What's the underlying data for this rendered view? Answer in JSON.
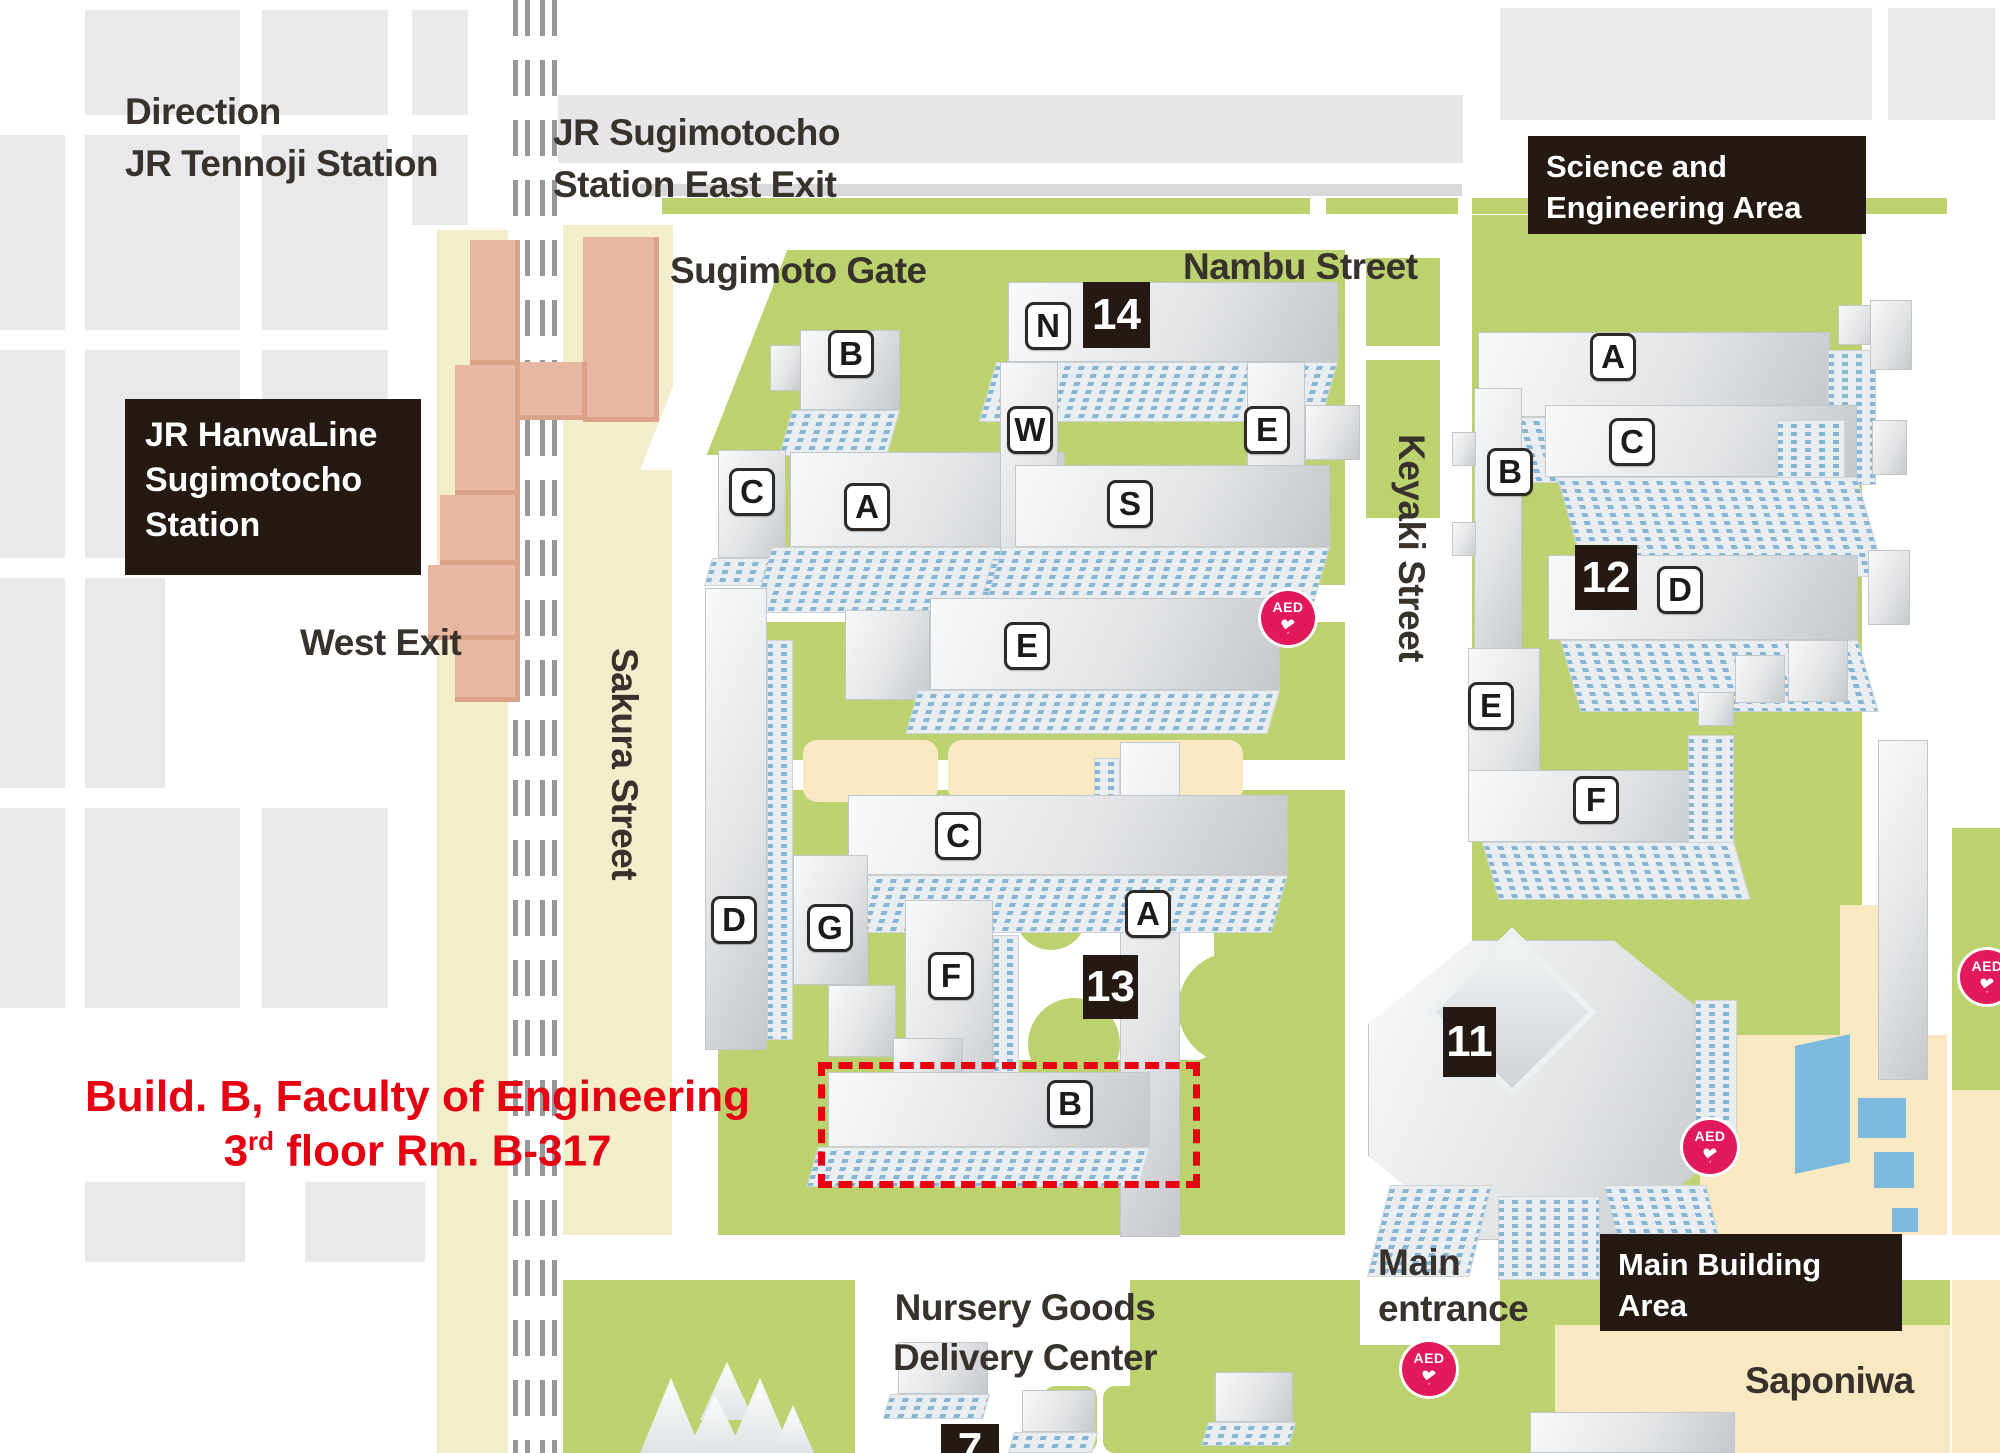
{
  "annotation": {
    "line1": "Build. B, Faculty of Engineering",
    "line2_pre": "3",
    "line2_sup": "rd",
    "line2_post": " floor Rm. B-317"
  },
  "area_badges": {
    "hanwa": [
      "JR HanwaLine",
      "Sugimotocho",
      "Station"
    ],
    "science": [
      "Science and",
      "Engineering Area"
    ],
    "main_building": [
      "Main Building",
      "Area"
    ]
  },
  "number_badges": {
    "n14": "14",
    "n12": "12",
    "n13": "13",
    "n11": "11",
    "n7": "7"
  },
  "streets": {
    "sugimoto_gate": "Sugimoto Gate",
    "nambu": "Nambu Street",
    "sakura": "Sakura Street",
    "keyaki": "Keyaki Street"
  },
  "directions": {
    "tennoji": [
      "Direction",
      "JR Tennoji Station"
    ],
    "east_exit": [
      "JR Sugimotocho",
      "Station East Exit"
    ],
    "west_exit": "West Exit"
  },
  "places": {
    "main_entrance": [
      "Main",
      "entrance"
    ],
    "nursery": [
      "Nursery Goods",
      "Delivery Center"
    ],
    "saponiwa": "Saponiwa"
  },
  "aed_label": "AED",
  "buildings": {
    "eng": {
      "b_top": "B",
      "c_small": "C",
      "a": "A",
      "n": "N",
      "w": "W",
      "e_quad": "E",
      "s": "S",
      "e_mid": "E",
      "c_mid": "C",
      "d": "D",
      "g": "G",
      "f": "F",
      "a_tower": "A",
      "b_eng": "B"
    },
    "sci": {
      "a": "A",
      "c": "C",
      "b": "B",
      "d": "D",
      "e": "E",
      "f": "F"
    }
  },
  "colors": {
    "accent_red": "#e60012",
    "campus_green": "#bcd26f",
    "station_pink": "#e8b7a1",
    "aed_pink": "#e2195b",
    "badge_black": "#241a13"
  }
}
